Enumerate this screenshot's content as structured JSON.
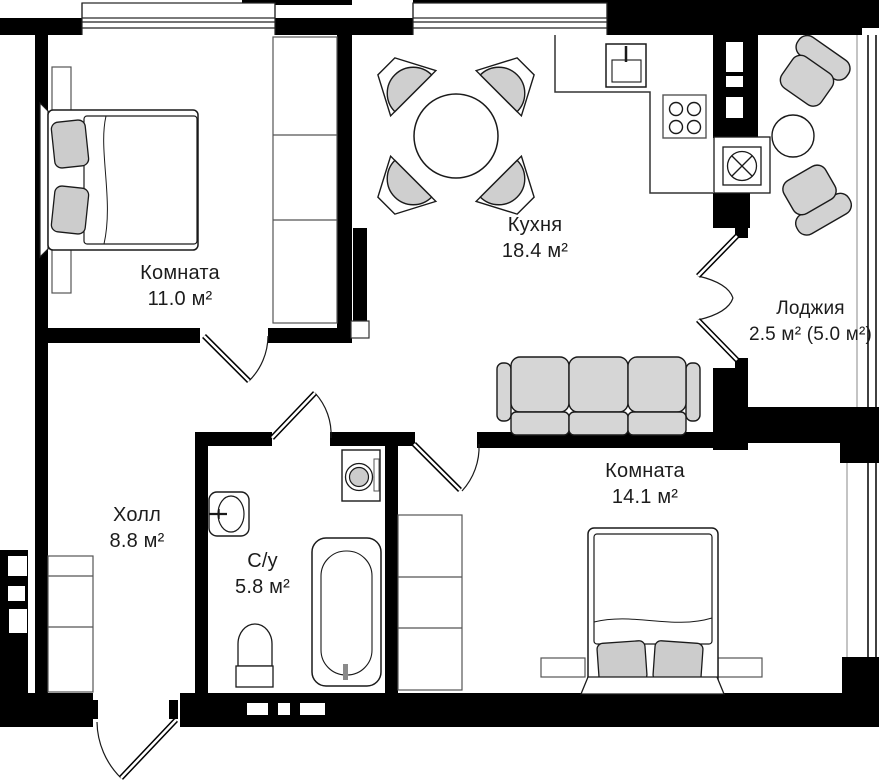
{
  "rooms": [
    {
      "key": "bedroom-1",
      "name": "Комната",
      "area": "11.0 м²"
    },
    {
      "key": "kitchen",
      "name": "Кухня",
      "area": "18.4 м²"
    },
    {
      "key": "loggia",
      "name": "Лоджия",
      "area": "2.5 м² (5.0 м²)"
    },
    {
      "key": "hall",
      "name": "Холл",
      "area": "8.8 м²"
    },
    {
      "key": "bathroom",
      "name": "С/у",
      "area": "5.8 м²"
    },
    {
      "key": "bedroom-2",
      "name": "Комната",
      "area": "14.1 м²"
    }
  ],
  "colors": {
    "wall": "#000000",
    "outline": "#1a1a1a",
    "furniture_fill": "#d2d2d2",
    "background": "#ffffff"
  }
}
